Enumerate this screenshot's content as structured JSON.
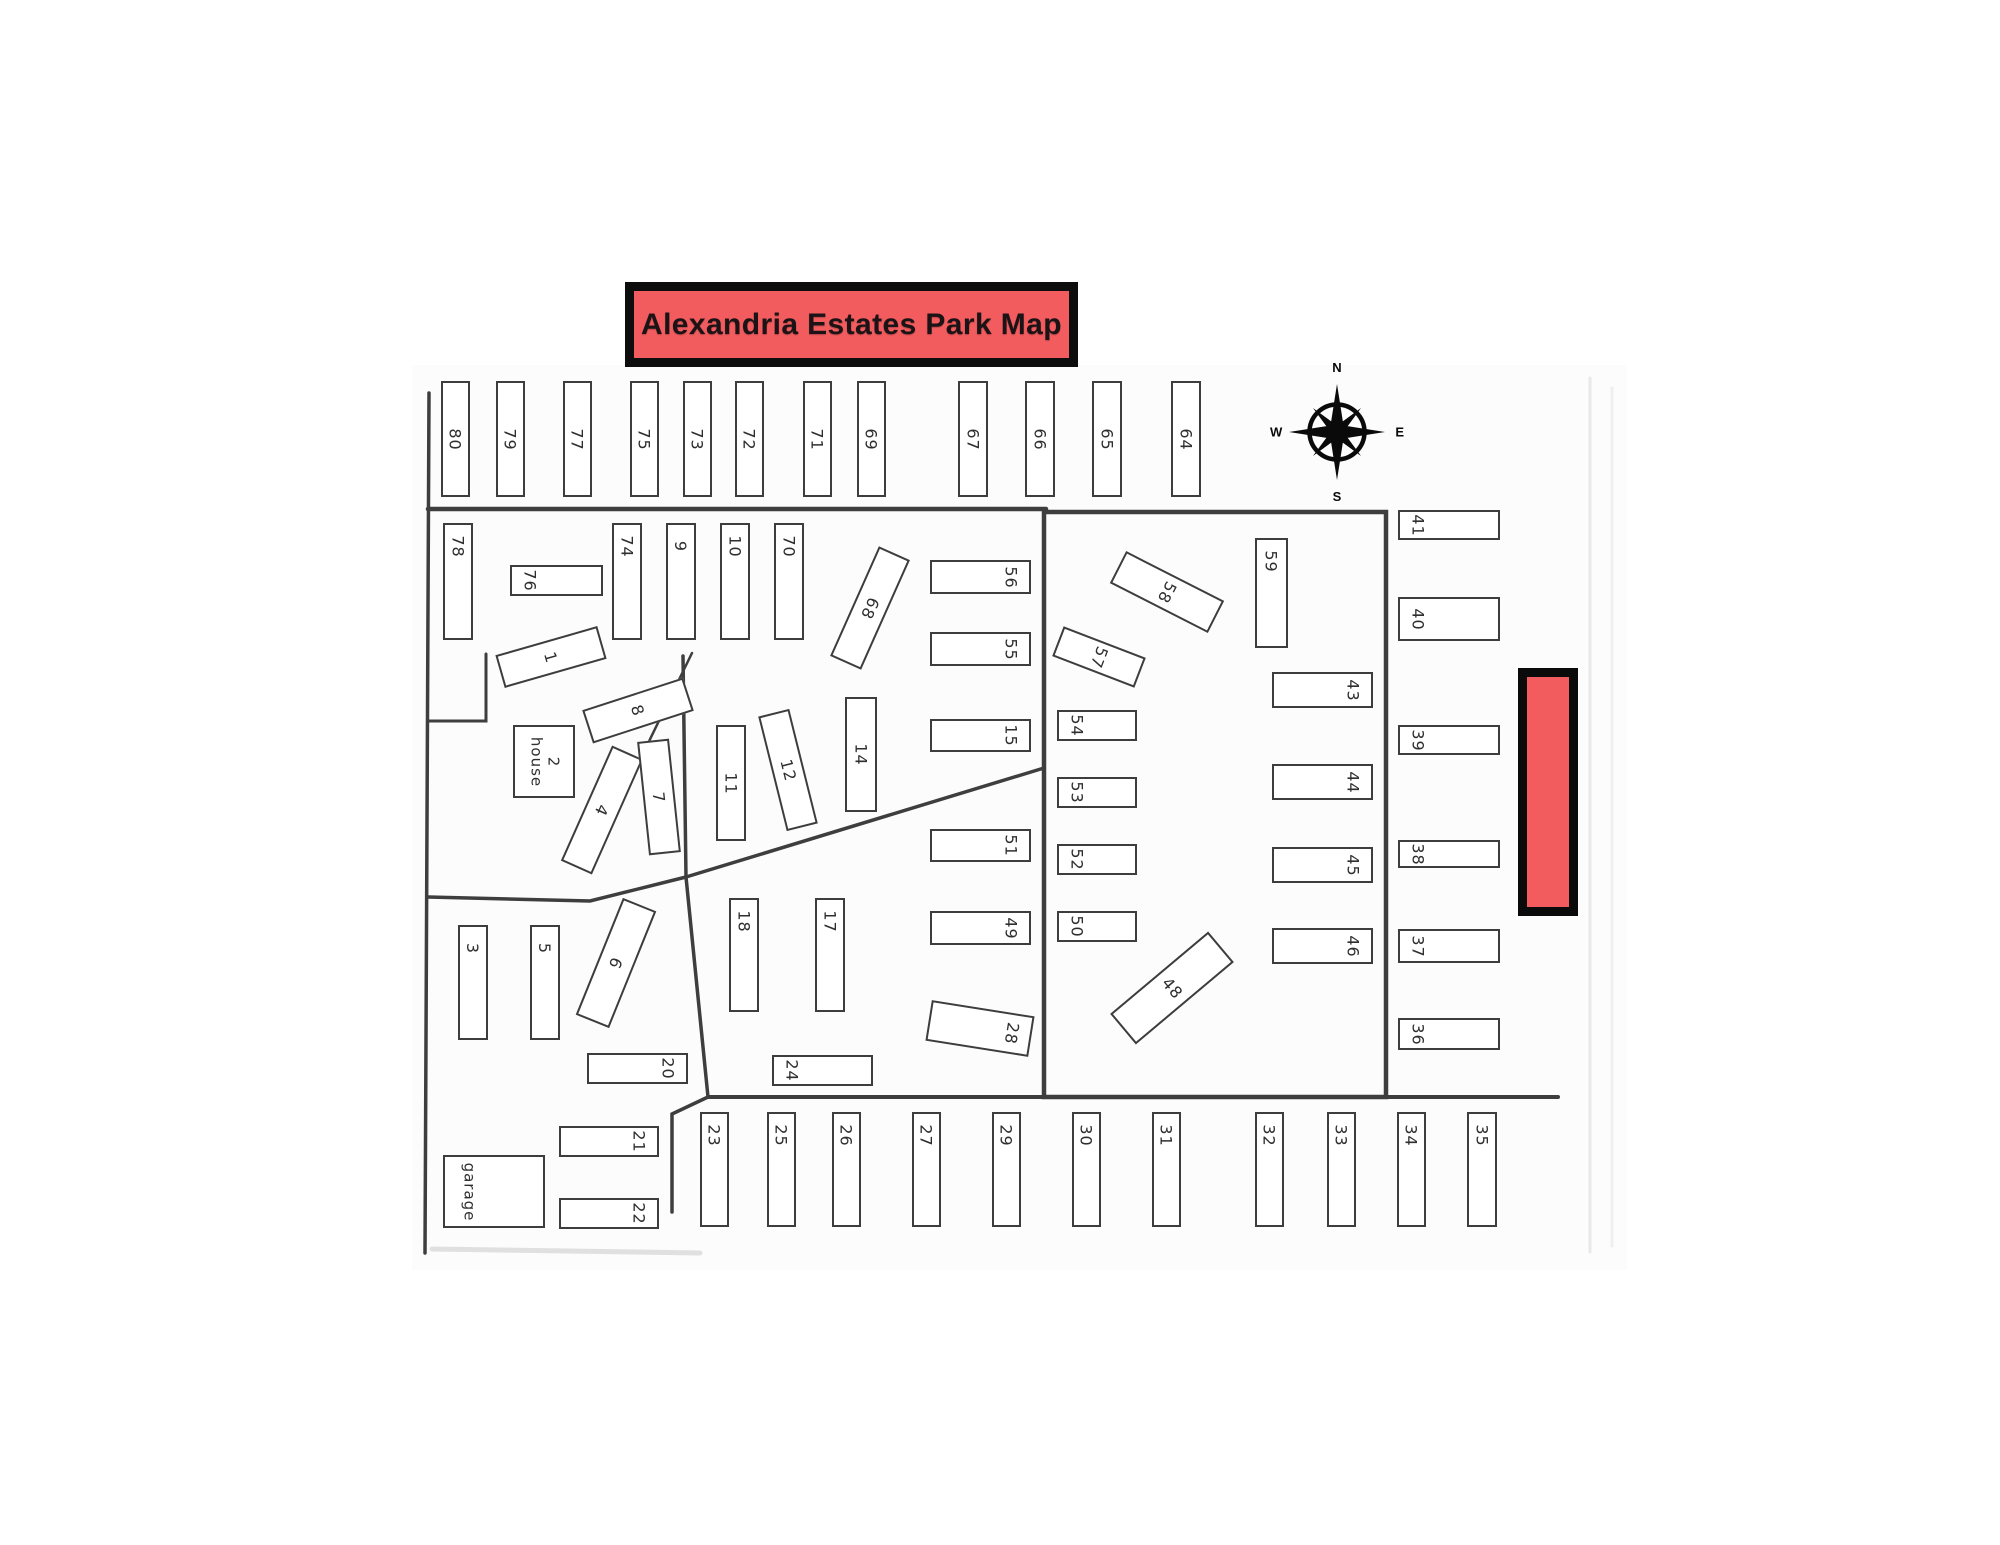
{
  "title": {
    "text": "Alexandria Estates Park Map"
  },
  "compass": {
    "n": "N",
    "e": "E",
    "s": "S",
    "w": "W"
  },
  "buildings": {
    "house_number": "2",
    "house_label": "house",
    "garage_label": "garage"
  },
  "colors": {
    "banner_red": "#f25c5e",
    "highlight_red": "#f25c5e",
    "line_gray": "#3d3d3d"
  },
  "lots": {
    "1": "1",
    "3": "3",
    "4": "4",
    "5": "5",
    "6": "6",
    "7": "7",
    "8": "8",
    "9": "9",
    "10": "10",
    "11": "11",
    "12": "12",
    "14": "14",
    "15": "15",
    "17": "17",
    "18": "18",
    "20": "20",
    "21": "21",
    "22": "22",
    "23": "23",
    "24": "24",
    "25": "25",
    "26": "26",
    "27": "27",
    "28": "28",
    "29": "29",
    "30": "30",
    "31": "31",
    "32": "32",
    "33": "33",
    "34": "34",
    "35": "35",
    "36": "36",
    "37": "37",
    "38": "38",
    "39": "39",
    "40": "40",
    "41": "41",
    "43": "43",
    "44": "44",
    "45": "45",
    "46": "46",
    "48": "48",
    "49": "49",
    "50": "50",
    "51": "51",
    "52": "52",
    "53": "53",
    "54": "54",
    "55": "55",
    "56": "56",
    "57": "57",
    "58": "58",
    "59": "59",
    "64": "64",
    "65": "65",
    "66": "66",
    "67": "67",
    "68": "68",
    "69": "69",
    "70": "70",
    "71": "71",
    "72": "72",
    "73": "73",
    "74": "74",
    "75": "75",
    "76": "76",
    "77": "77",
    "78": "78",
    "79": "79",
    "80": "80"
  }
}
